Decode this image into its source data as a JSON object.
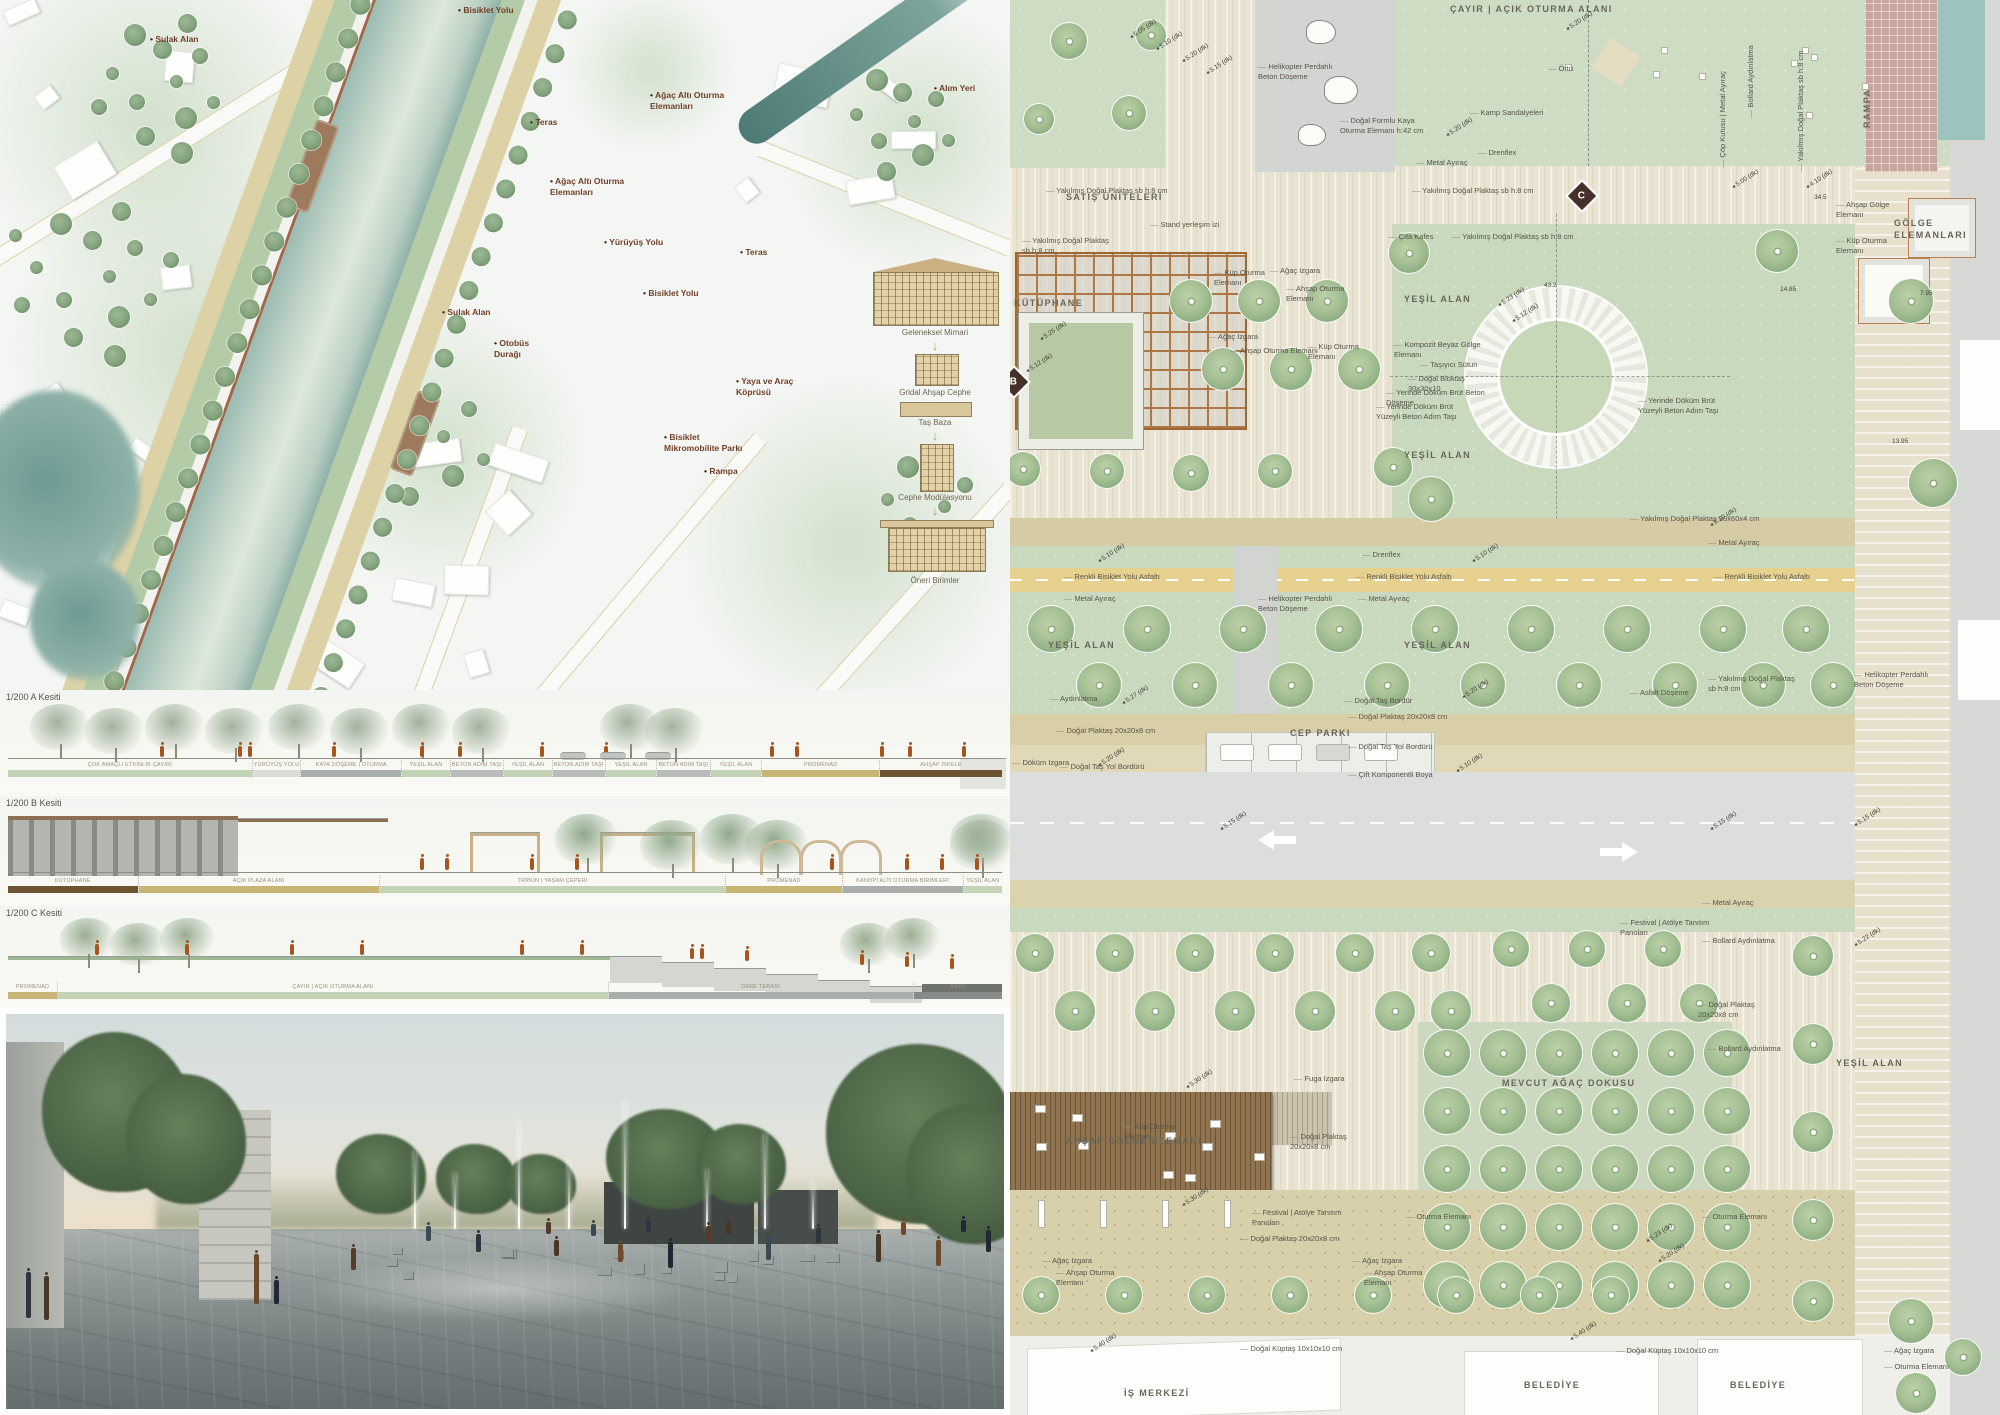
{
  "site_plan": {
    "labels": [
      {
        "t": "Sulak Alan",
        "x": 150,
        "y": 34
      },
      {
        "t": "Bisiklet Yolu",
        "x": 458,
        "y": 5
      },
      {
        "t": "Ağaç Altı Oturma Elemanları",
        "x": 650,
        "y": 90,
        "w": 80
      },
      {
        "t": "Alım Yeri",
        "x": 934,
        "y": 83
      },
      {
        "t": "Teras",
        "x": 530,
        "y": 117
      },
      {
        "t": "Ağaç Altı Oturma Elemanları",
        "x": 550,
        "y": 176,
        "w": 80
      },
      {
        "t": "Yürüyüş Yolu",
        "x": 604,
        "y": 237
      },
      {
        "t": "Teras",
        "x": 740,
        "y": 247
      },
      {
        "t": "Bisiklet Yolu",
        "x": 643,
        "y": 288
      },
      {
        "t": "Sulak Alan",
        "x": 442,
        "y": 307
      },
      {
        "t": "Otobüs Durağı",
        "x": 494,
        "y": 338,
        "w": 50
      },
      {
        "t": "Bisiklet Mikromobilite Parkı",
        "x": 664,
        "y": 432,
        "w": 86
      },
      {
        "t": "Rampa",
        "x": 704,
        "y": 466
      },
      {
        "t": "Yaya ve Araç Köprüsü",
        "x": 736,
        "y": 376,
        "w": 74
      }
    ],
    "legend": [
      "Geleneksel Mimari",
      "Gridal Ahşap Cephe",
      "Taş Baza",
      "Cephe Modülasyonu",
      "Öneri Birimler"
    ]
  },
  "sections": {
    "a_title": "1/200 A Kesiti",
    "b_title": "1/200 B Kesiti",
    "c_title": "1/200 C Kesiti",
    "a_segments": [
      {
        "t": "ÇOK AMAÇLI ETKİNLİK ÇAYIRI",
        "flex": 240,
        "c": "tone-green"
      },
      {
        "t": "YÜRÜYÜŞ YOLU",
        "flex": 42,
        "c": "tone-light"
      },
      {
        "t": "KAYA DÖŞEME | OTURMA",
        "flex": 98,
        "c": "tone-gray"
      },
      {
        "t": "YEŞİL ALAN",
        "flex": 47,
        "c": "tone-green"
      },
      {
        "t": "BETON ADIM TAŞI",
        "flex": 46,
        "c": "tone-stone"
      },
      {
        "t": "YEŞİL ALAN",
        "flex": 47,
        "c": "tone-green"
      },
      {
        "t": "BETON ADIM TAŞI",
        "flex": 46,
        "c": "tone-stone"
      },
      {
        "t": "YEŞİL ALAN",
        "flex": 50,
        "c": "tone-green"
      },
      {
        "t": "BETON ADIM TAŞI",
        "flex": 42,
        "c": "tone-stone"
      },
      {
        "t": "YEŞİL ALAN",
        "flex": 50,
        "c": "tone-green"
      },
      {
        "t": "PROMENAD",
        "flex": 115,
        "c": "tone-sand"
      },
      {
        "t": "AHŞAP İSKELE",
        "flex": 120,
        "c": "tone-wood"
      }
    ],
    "b_segments": [
      {
        "t": "KÜTÜPHANE",
        "flex": 135,
        "c": "tone-wood"
      },
      {
        "t": "AÇIK PLAZA ALANI",
        "flex": 250,
        "c": "tone-sand"
      },
      {
        "t": "TRİBÜN | YAŞAM ÇEPERİ",
        "flex": 360,
        "c": "tone-green"
      },
      {
        "t": "PROMENAD",
        "flex": 120,
        "c": "tone-sand"
      },
      {
        "t": "KANOPİ ALTI OTURMA BİRİMLERİ",
        "flex": 125,
        "c": "tone-gray"
      },
      {
        "t": "YEŞİL ALAN",
        "flex": 40,
        "c": "tone-green"
      }
    ],
    "c_segments": [
      {
        "t": "PROMENAD",
        "flex": 50,
        "c": "tone-sand"
      },
      {
        "t": "ÇAYIR | AÇIK OTURMA ALANI",
        "flex": 560,
        "c": "tone-green"
      },
      {
        "t": "DERE TERASI",
        "flex": 310,
        "c": "tone-gray"
      },
      {
        "t": "KAYA",
        "flex": 90,
        "c": "tone-rock"
      }
    ]
  },
  "master_plan": {
    "markers": [
      {
        "t": "B",
        "x": -6,
        "y": 372
      },
      {
        "t": "C",
        "x": 562,
        "y": 186
      }
    ],
    "labels": [
      {
        "t": "ÇAYIR | AÇIK OTURMA ALANI",
        "x": 440,
        "y": 4,
        "c": "area"
      },
      {
        "t": "Helikopter Perdahlı Beton Döşeme",
        "x": 248,
        "y": 62,
        "w": 82
      },
      {
        "t": "Doğal Formlu Kaya Oturma Elemanı h:42 cm",
        "x": 330,
        "y": 116,
        "w": 98
      },
      {
        "t": "Örtü",
        "x": 538,
        "y": 64
      },
      {
        "t": "Kamp Sandalyeleri",
        "x": 460,
        "y": 108
      },
      {
        "t": "Drenflex",
        "x": 468,
        "y": 148
      },
      {
        "t": "Metal Ayıraç",
        "x": 406,
        "y": 158
      },
      {
        "t": "Yakılmış Doğal Plaktaş sb h:8 cm",
        "x": 36,
        "y": 186
      },
      {
        "t": "Yakılmış Doğal Plaktaş sb h:8 cm",
        "x": 402,
        "y": 186
      },
      {
        "t": "SATIŞ ÜNİTELERİ",
        "x": 56,
        "y": 192,
        "c": "area"
      },
      {
        "t": "Stand yerleşim izi",
        "x": 140,
        "y": 220
      },
      {
        "t": "Yakılmış Doğal Plaktaş sb h:8 cm",
        "x": 12,
        "y": 236,
        "w": 92
      },
      {
        "t": "Çıta Kafes",
        "x": 378,
        "y": 232
      },
      {
        "t": "Yakılmış Doğal Plaktaş sb h:8 cm",
        "x": 442,
        "y": 232
      },
      {
        "t": "KÜTÜPHANE",
        "x": 4,
        "y": 298,
        "c": "area"
      },
      {
        "t": "Küp Oturma Elemanı",
        "x": 204,
        "y": 268,
        "w": 62
      },
      {
        "t": "Ağaç Izgara",
        "x": 260,
        "y": 266
      },
      {
        "t": "Ahşap Oturma Elemanı",
        "x": 276,
        "y": 284,
        "w": 72
      },
      {
        "t": "Ağaç Izgara",
        "x": 198,
        "y": 332
      },
      {
        "t": "Ahşap Oturma Elemanı",
        "x": 220,
        "y": 346,
        "w": 92
      },
      {
        "t": "Küp Oturma Elemanı",
        "x": 298,
        "y": 342,
        "w": 62
      },
      {
        "t": "YEŞİL ALAN",
        "x": 394,
        "y": 294,
        "c": "area"
      },
      {
        "t": "Kompozit Beyaz Gölge Elemanı",
        "x": 384,
        "y": 340,
        "w": 92
      },
      {
        "t": "Taşıyıcı Sütun",
        "x": 410,
        "y": 360
      },
      {
        "t": "Doğal Bloktaş 30x30x10",
        "x": 398,
        "y": 374,
        "w": 82
      },
      {
        "t": "Yerinde Döküm Brüt Beton Döşeme",
        "x": 376,
        "y": 388,
        "w": 112
      },
      {
        "t": "Yerinde Döküm Brüt Yüzeyli Beton Adım Taşı",
        "x": 366,
        "y": 402,
        "w": 102
      },
      {
        "t": "Yerinde Döküm Brüt Yüzeyli Beton Adım Taşı",
        "x": 628,
        "y": 396,
        "w": 102
      },
      {
        "t": "YEŞİL ALAN",
        "x": 394,
        "y": 450,
        "c": "area"
      },
      {
        "t": "Yakılmış Doğal Plaktaş 30x60x4 cm",
        "x": 620,
        "y": 514
      },
      {
        "t": "Metal Ayıraç",
        "x": 698,
        "y": 538
      },
      {
        "t": "Drenflex",
        "x": 352,
        "y": 550
      },
      {
        "t": "Renkli Bisiklet Yolu Asfaltı",
        "x": 54,
        "y": 572
      },
      {
        "t": "Renkli Bisiklet Yolu Asfaltı",
        "x": 346,
        "y": 572
      },
      {
        "t": "Renkli Bisiklet Yolu Asfaltı",
        "x": 704,
        "y": 572
      },
      {
        "t": "Metal Ayıraç",
        "x": 54,
        "y": 594
      },
      {
        "t": "Metal Ayıraç",
        "x": 348,
        "y": 594
      },
      {
        "t": "Helikopter Perdahlı Beton Döşeme",
        "x": 248,
        "y": 594,
        "w": 88
      },
      {
        "t": "YEŞİL ALAN",
        "x": 38,
        "y": 640,
        "c": "area"
      },
      {
        "t": "YEŞİL ALAN",
        "x": 394,
        "y": 640,
        "c": "area"
      },
      {
        "t": "Yakılmış Doğal Plaktaş sb h:8 cm",
        "x": 698,
        "y": 674,
        "w": 96
      },
      {
        "t": "Helikopter Perdahlı Beton Döşeme",
        "x": 844,
        "y": 670,
        "w": 82
      },
      {
        "t": "Aydınlatma",
        "x": 40,
        "y": 694
      },
      {
        "t": "Doğal Taş Bordür",
        "x": 334,
        "y": 696
      },
      {
        "t": "Asfalt Döşeme",
        "x": 620,
        "y": 688
      },
      {
        "t": "Doğal Plaktaş 20x20x8 cm",
        "x": 46,
        "y": 726
      },
      {
        "t": "Doğal Plaktaş 20x20x8 cm",
        "x": 338,
        "y": 712
      },
      {
        "t": "CEP PARKI",
        "x": 280,
        "y": 728,
        "c": "area"
      },
      {
        "t": "Doğal Taş Yol Bordürü",
        "x": 50,
        "y": 762
      },
      {
        "t": "Doğal Taş Yol Bordürü",
        "x": 338,
        "y": 742
      },
      {
        "t": "Döküm Izgara",
        "x": 2,
        "y": 758
      },
      {
        "t": "Çift Komponentli Boya",
        "x": 338,
        "y": 770
      },
      {
        "t": "Metal Ayıraç",
        "x": 692,
        "y": 898
      },
      {
        "t": "Bollard Aydınlatma",
        "x": 692,
        "y": 936
      },
      {
        "t": "Festival | Atölye Tanıtım Panoları",
        "x": 610,
        "y": 918,
        "w": 102
      },
      {
        "t": "Doğal Plaktaş 20x20x8 cm",
        "x": 688,
        "y": 1000,
        "w": 84
      },
      {
        "t": "MEVCUT AĞAÇ DOKUSU",
        "x": 492,
        "y": 1078,
        "c": "area"
      },
      {
        "t": "Bollard Aydınlatma",
        "x": 698,
        "y": 1044
      },
      {
        "t": "YEŞİL ALAN",
        "x": 826,
        "y": 1058,
        "c": "area"
      },
      {
        "t": "Fuga Izgara",
        "x": 284,
        "y": 1074
      },
      {
        "t": "Küp Oturma Elemanı",
        "x": 114,
        "y": 1122,
        "w": 66
      },
      {
        "t": "AHŞAP GÖLGE ELEMANI",
        "x": 56,
        "y": 1136,
        "c": "area"
      },
      {
        "t": "Doğal Plaktaş 20x20x8 cm",
        "x": 280,
        "y": 1132,
        "w": 82
      },
      {
        "t": "Festival | Atölye Tanıtım Panoları",
        "x": 242,
        "y": 1208,
        "w": 112
      },
      {
        "t": "Doğal Plaktaş 20x20x8 cm",
        "x": 230,
        "y": 1234
      },
      {
        "t": "Oturma Elemanı",
        "x": 396,
        "y": 1212
      },
      {
        "t": "Oturma Elemanı",
        "x": 692,
        "y": 1212
      },
      {
        "t": "Ağaç Izgara",
        "x": 32,
        "y": 1256
      },
      {
        "t": "Ahşap Oturma Elemanı",
        "x": 46,
        "y": 1268,
        "w": 72
      },
      {
        "t": "Ağaç Izgara",
        "x": 342,
        "y": 1256
      },
      {
        "t": "Ahşap Oturma Elemanı",
        "x": 354,
        "y": 1268,
        "w": 72
      },
      {
        "t": "Doğal Küptaş 10x10x10 cm",
        "x": 230,
        "y": 1344
      },
      {
        "t": "Doğal Küptaş 10x10x10 cm",
        "x": 606,
        "y": 1346
      },
      {
        "t": "Ağaç Izgara",
        "x": 874,
        "y": 1346
      },
      {
        "t": "Oturma Elemanı",
        "x": 874,
        "y": 1362
      },
      {
        "t": "İŞ MERKEZİ",
        "x": 114,
        "y": 1388,
        "c": "area"
      },
      {
        "t": "BELEDİYE",
        "x": 514,
        "y": 1380,
        "c": "area"
      },
      {
        "t": "BELEDİYE",
        "x": 720,
        "y": 1380,
        "c": "area"
      },
      {
        "t": "Ahşap Gölge Elemanı",
        "x": 826,
        "y": 200,
        "w": 64
      },
      {
        "t": "Küp Oturma Elemanı",
        "x": 826,
        "y": 236,
        "w": 64
      },
      {
        "t": "GÖLGE ELEMANLARI",
        "x": 884,
        "y": 218,
        "w": 72,
        "c": "area"
      },
      {
        "t": "RAMPA",
        "x": 852,
        "y": 128,
        "c": "area vert"
      },
      {
        "t": "Bollard Aydınlatma",
        "x": 736,
        "y": 118,
        "c": "vert"
      },
      {
        "t": "Yakılmış Doğal Plaktaş sb h:8 cm",
        "x": 786,
        "y": 172,
        "c": "vert"
      },
      {
        "t": "Çöp Kutusu | Metal Ayıraç",
        "x": 708,
        "y": 168,
        "c": "vert"
      }
    ],
    "dims": [
      {
        "t": "5.05 (dk)",
        "x": 118,
        "y": 26
      },
      {
        "t": "5.10 (dk)",
        "x": 144,
        "y": 38
      },
      {
        "t": "5.20 (dk)",
        "x": 170,
        "y": 50
      },
      {
        "t": "5.15 (dk)",
        "x": 194,
        "y": 62
      },
      {
        "t": "5.20 (dk)",
        "x": 434,
        "y": 124
      },
      {
        "t": "5.20 (dk)",
        "x": 554,
        "y": 18
      },
      {
        "t": "5.00 (dk)",
        "x": 720,
        "y": 176
      },
      {
        "t": "4.10 (dk)",
        "x": 794,
        "y": 176
      },
      {
        "t": "5.23 (dk)",
        "x": 486,
        "y": 294
      },
      {
        "t": "5.12 (dk)",
        "x": 500,
        "y": 310
      },
      {
        "t": "43.2",
        "x": 534,
        "y": 282,
        "c": "flat"
      },
      {
        "t": "34.5",
        "x": 804,
        "y": 194,
        "c": "flat"
      },
      {
        "t": "14.85",
        "x": 770,
        "y": 286,
        "c": "flat"
      },
      {
        "t": "7.95",
        "x": 910,
        "y": 290,
        "c": "flat"
      },
      {
        "t": "13.95",
        "x": 882,
        "y": 438,
        "c": "flat"
      },
      {
        "t": "5.25 (dk)",
        "x": 28,
        "y": 328
      },
      {
        "t": "5.12 (dk)",
        "x": 14,
        "y": 360
      },
      {
        "t": "5.10 (dk)",
        "x": 86,
        "y": 550
      },
      {
        "t": "5.10 (dk)",
        "x": 460,
        "y": 550
      },
      {
        "t": "5.10 (dk)",
        "x": 698,
        "y": 514
      },
      {
        "t": "5.27 (dk)",
        "x": 110,
        "y": 692
      },
      {
        "t": "5.20 (dk)",
        "x": 450,
        "y": 686
      },
      {
        "t": "5.20 (dk)",
        "x": 86,
        "y": 754
      },
      {
        "t": "5.10 (dk)",
        "x": 444,
        "y": 760
      },
      {
        "t": "5.15 (dk)",
        "x": 208,
        "y": 818
      },
      {
        "t": "5.15 (dk)",
        "x": 698,
        "y": 818
      },
      {
        "t": "5.15 (dk)",
        "x": 842,
        "y": 814
      },
      {
        "t": "5.22 (dk)",
        "x": 842,
        "y": 934
      },
      {
        "t": "5.30 (dk)",
        "x": 174,
        "y": 1076
      },
      {
        "t": "5.30 (dk)",
        "x": 170,
        "y": 1194
      },
      {
        "t": "5.23 (dk)",
        "x": 634,
        "y": 1230
      },
      {
        "t": "5.20 (dk)",
        "x": 646,
        "y": 1250
      },
      {
        "t": "5.40 (dk)",
        "x": 78,
        "y": 1340
      },
      {
        "t": "5.40 (dk)",
        "x": 558,
        "y": 1328
      }
    ]
  }
}
